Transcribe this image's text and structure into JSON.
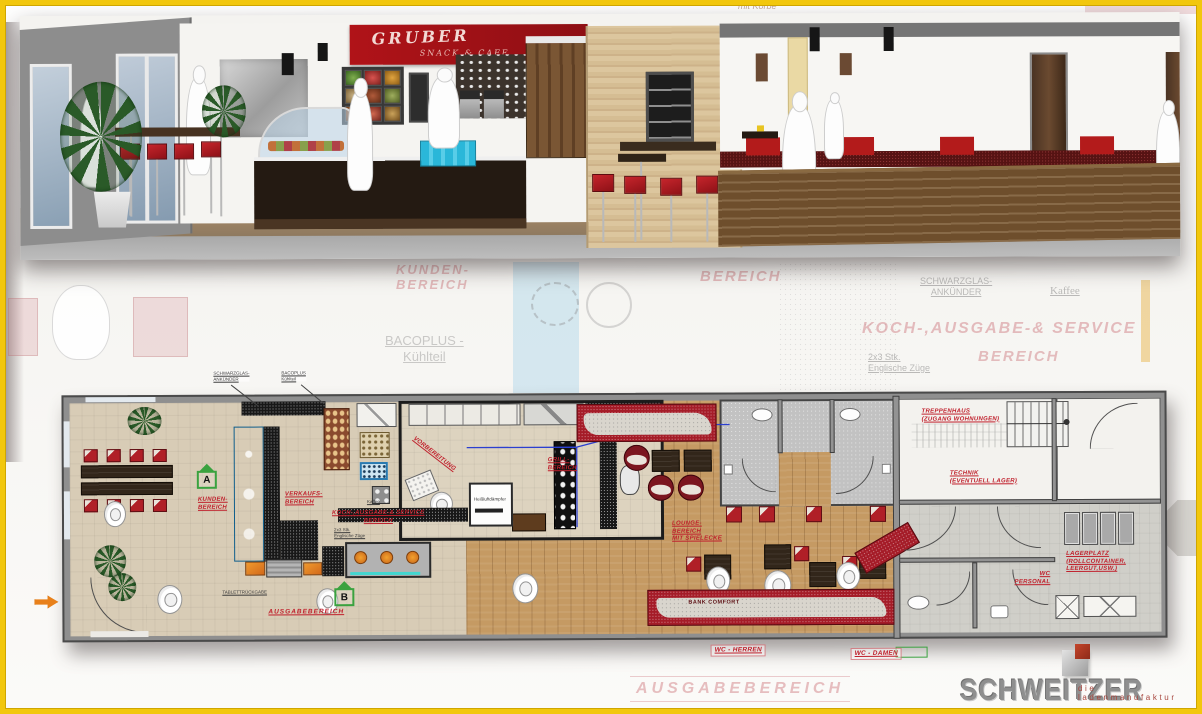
{
  "colors": {
    "frame_yellow": "#f2c70d",
    "label_red": "#c0202c",
    "chair_red": "#b01f27",
    "sign_red": "#a31318",
    "counter_blue": "#2fa3dc",
    "marker_green": "#3aa23f",
    "logo_gray": "#8f8f8f",
    "wood_floor": "#c59a63"
  },
  "render": {
    "sign": {
      "line1": "GRUBER",
      "line2": "SNACK & CAFE"
    }
  },
  "watermark": {
    "mit_koerbe": "mit Körbe",
    "kunden": "KUNDEN-\nBEREICH",
    "bereich_a": "BEREICH",
    "bacoplus": "BACOPLUS -\nKühlteil",
    "schwarzglas": "SCHWARZGLAS-\nANKÜNDER",
    "kaffee": "Kaffee",
    "koch": "KOCH-,AUSGABE-& SERVICE",
    "bereich_b": "BEREICH",
    "stk": "2x3 Stk.\nEnglische Züge",
    "ausgabe": "AUSGABEBEREICH"
  },
  "plan": {
    "labels": {
      "kunden": "KUNDEN-\nBEREICH",
      "verkauf": "VERKAUFS-\nBEREICH",
      "vorbereitung": "VORBEREITUNG",
      "grill": "GRILL-\nBEREICH",
      "koch": "KOCH-,AUSGABE-& SERVICE\nBEREICH",
      "ausgabe": "AUSGABEBEREICH",
      "lounge": "LOUNGE-\nBEREICH\nMIT SPIELECKE",
      "bank": "BANK COMFORT",
      "treppenhaus": "TREPPENHAUS\n(ZUGANG WOHNUNGEN)",
      "technik": "TECHNIK\n(EVENTUELL LAGER)",
      "lagerplatz": "LAGERPLATZ\n(ROLLCONTAINER,\nLEERGUT,USW.)",
      "wc_personal": "WC\nPERSONAL",
      "wc_herren": "WC - HERREN",
      "wc_damen": "WC - DAMEN",
      "heissluft": "Heißluftdämpfer"
    },
    "callouts": {
      "schwarzglas": "SCHWARZGLAS-\nANKÜNDER",
      "bacoplus": "BACOPLUS\nKühlteil",
      "kaffee": "Kaffee",
      "stk": "2x3 Stk.\nEnglische Züge",
      "tablett": "TABLETTRÜCKGABE"
    },
    "markers": {
      "a": "A",
      "b": "B"
    }
  },
  "logo": {
    "name": "SCHWEITZER",
    "tagline": "die ladenmanufaktur"
  }
}
